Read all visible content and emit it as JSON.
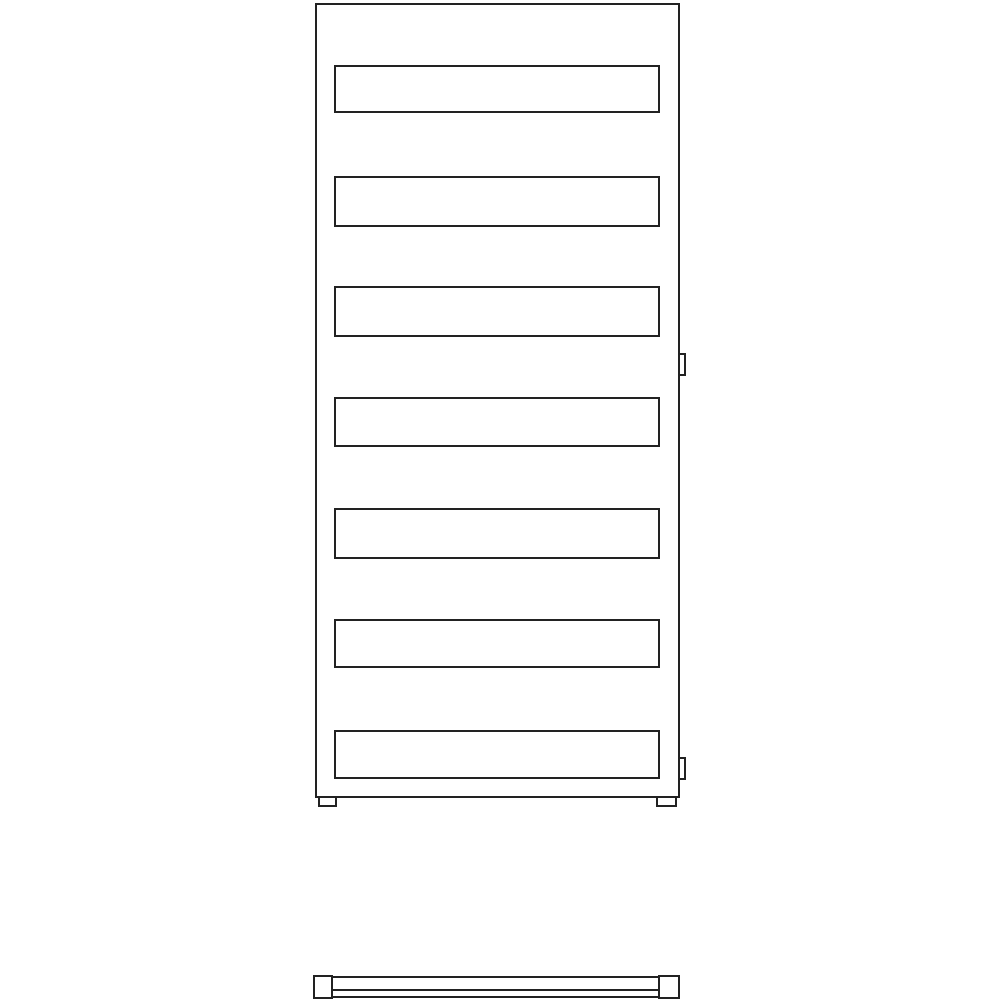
{
  "canvas": {
    "width": 1000,
    "height": 1000,
    "background": "#ffffff"
  },
  "drawing": {
    "type": "technical-line-drawing",
    "subject": "towel-radiator-elevation-and-plan",
    "line_color": "#222222",
    "line_width": 2,
    "front_view": {
      "frame": {
        "x": 315,
        "y": 3,
        "width": 365,
        "height": 795
      },
      "slat_x": 334,
      "slat_width": 326,
      "slats": [
        {
          "top": 65,
          "height": 48
        },
        {
          "top": 176,
          "height": 51
        },
        {
          "top": 286,
          "height": 51
        },
        {
          "top": 397,
          "height": 50
        },
        {
          "top": 508,
          "height": 51
        },
        {
          "top": 619,
          "height": 49
        },
        {
          "top": 730,
          "height": 49
        }
      ],
      "wall_brackets": [
        {
          "x": 678,
          "y": 353,
          "width": 8,
          "height": 23
        },
        {
          "x": 678,
          "y": 757,
          "width": 8,
          "height": 23
        }
      ],
      "feet": [
        {
          "x": 318,
          "y": 796,
          "width": 19,
          "height": 11
        },
        {
          "x": 656,
          "y": 796,
          "width": 21,
          "height": 11
        }
      ]
    },
    "top_view": {
      "end_caps": [
        {
          "x": 313,
          "y": 975,
          "width": 20,
          "height": 24
        },
        {
          "x": 658,
          "y": 975,
          "width": 22,
          "height": 24
        }
      ],
      "tube": {
        "x": 331,
        "y": 976,
        "width": 329,
        "height": 22
      },
      "divider": {
        "x": 333,
        "y": 989,
        "width": 325,
        "height": 2
      }
    }
  }
}
